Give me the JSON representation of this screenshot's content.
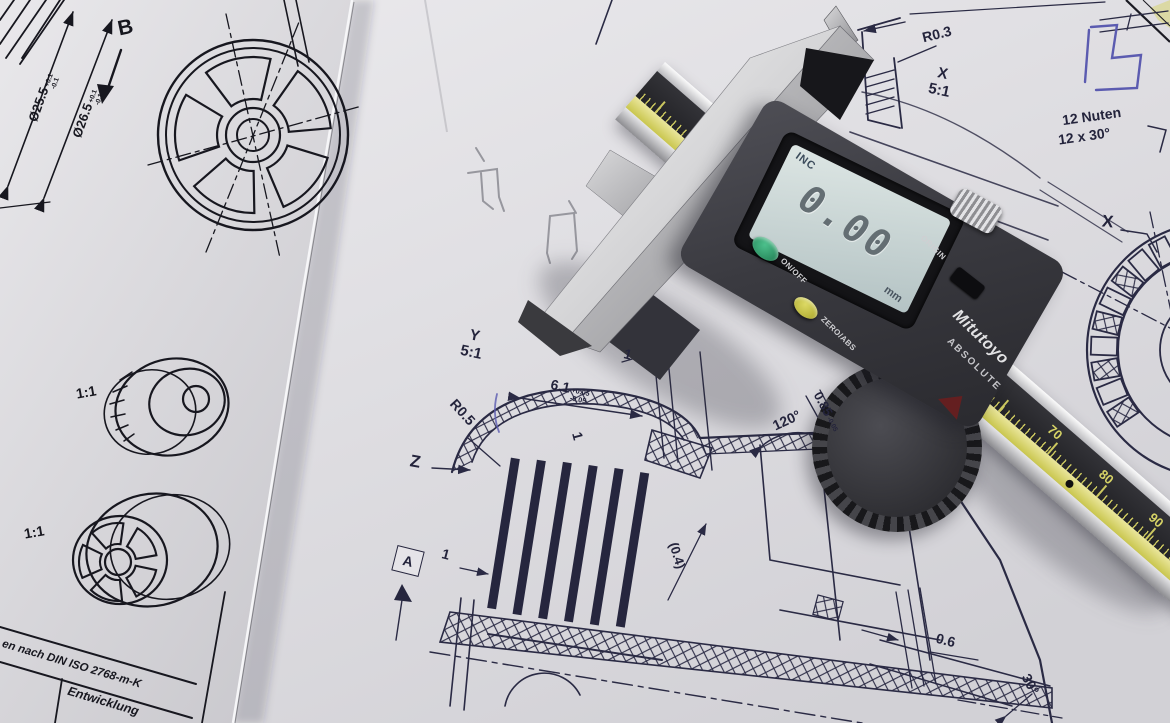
{
  "left_sheet": {
    "view_arrow": "B",
    "dims": [
      {
        "value": "Ø25.5",
        "tol_plus": "+0.1",
        "tol_minus": "-0.1"
      },
      {
        "value": "Ø26.5",
        "tol_plus": "+0.1",
        "tol_minus": "-0.1"
      }
    ],
    "scale_labels": [
      "1:1",
      "1:1"
    ],
    "title_block": {
      "tolerance_note": "en nach DIN ISO 2768-m-K",
      "row_label": "Entwicklung"
    }
  },
  "right_sheet": {
    "detail_x": {
      "letter": "X",
      "scale": "5:1"
    },
    "detail_y": {
      "letter": "Y",
      "scale": "5:1"
    },
    "radius_r03": "R0.3",
    "radius_r05": "R0.5",
    "note_nuten_line1": "12 Nuten",
    "note_nuten_line2": "12 x 30°",
    "leader_x": "X",
    "leader_z": "Z",
    "datum_label": "A",
    "dim_61": {
      "value": "6.1",
      "tol_plus": "+0.05",
      "tol_minus": "-0.05"
    },
    "dim_085": {
      "value": "0.85",
      "tol_minus": "-0.05"
    },
    "dim_04": "(0.4)",
    "dim_06": "0.6",
    "angle_120": "120°",
    "angle_30": "30°",
    "unit_dims": [
      "1",
      "1",
      "1"
    ]
  },
  "caliper": {
    "brand": "Mitutoyo",
    "series": "ABSOLUTE",
    "display": {
      "mode": "INC",
      "value": "0.00",
      "unit": "mm"
    },
    "buttons": {
      "power": "ON/OFF",
      "zero": "ZERO/ABS",
      "origin": "ORIGIN"
    },
    "scale": {
      "zero": "0",
      "numbers": [
        "70",
        "80",
        "90"
      ]
    },
    "colors": {
      "power_button": "#2fa372",
      "zero_button": "#c9c53c",
      "scale_band": "#2a2a2e",
      "scale_accent": "#d6d366",
      "lcd_bg": "#ccd7d6",
      "body": "#3a3a40"
    }
  }
}
